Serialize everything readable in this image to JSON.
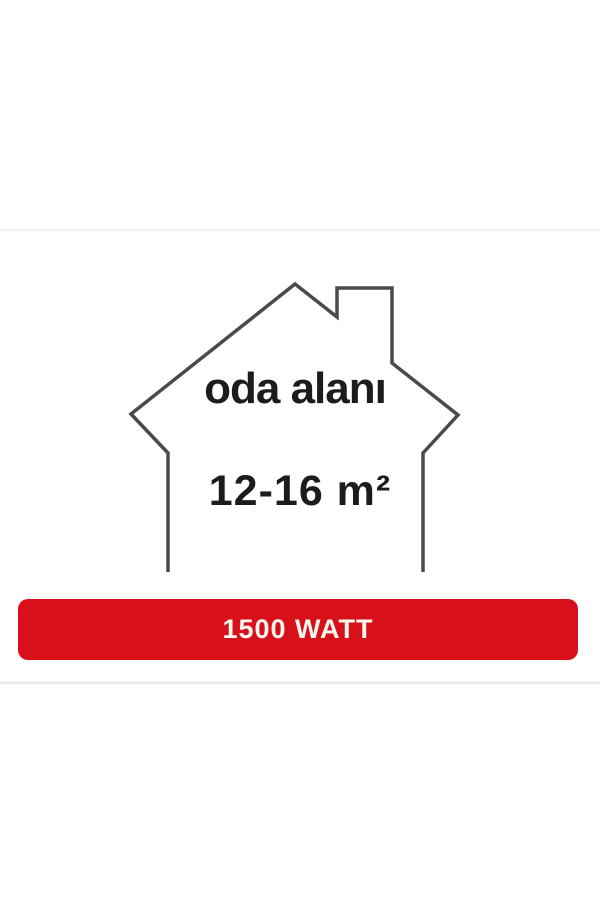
{
  "house": {
    "room_label": "oda alanı",
    "area_value": "12-16 m²",
    "outline_color": "#4a4a4a",
    "text_color": "#1c1c1c"
  },
  "watt_badge": {
    "label": "1500 WATT",
    "background_color": "#d8101a",
    "text_color": "#fdf7ee"
  }
}
